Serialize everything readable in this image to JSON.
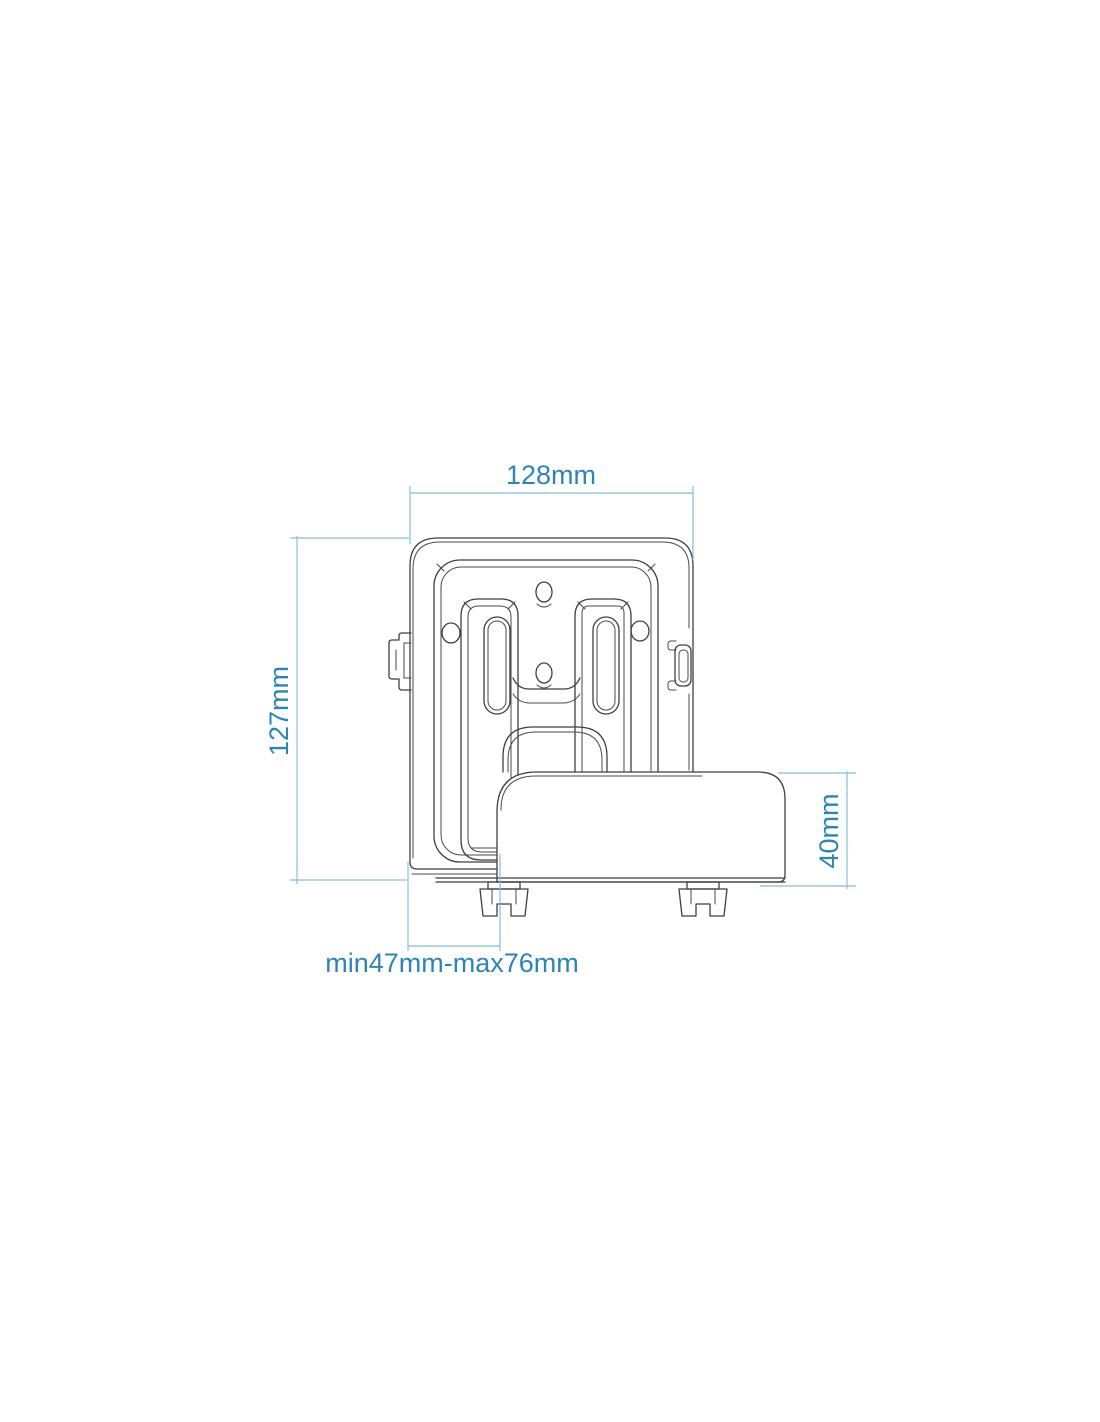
{
  "drawing": {
    "type": "technical-diagram",
    "subject": "wall-mount bracket with mounted media device, front view",
    "colors": {
      "background": "#ffffff",
      "drawing_line": "#3f3f3f",
      "dimension_line": "#85bdda",
      "dimension_text": "#2e85b5"
    },
    "dimensions": [
      {
        "id": "bracket-width",
        "label": "128mm",
        "value_mm": 128,
        "orientation": "horizontal",
        "position": "top"
      },
      {
        "id": "bracket-height",
        "label": "127mm",
        "value_mm": 127,
        "orientation": "vertical",
        "position": "left"
      },
      {
        "id": "device-height",
        "label": "40mm",
        "value_mm": 40,
        "orientation": "vertical",
        "position": "right"
      },
      {
        "id": "holder-range",
        "label": "min47mm-max76mm",
        "min_mm": 47,
        "max_mm": 76,
        "orientation": "horizontal",
        "position": "bottom"
      }
    ]
  }
}
